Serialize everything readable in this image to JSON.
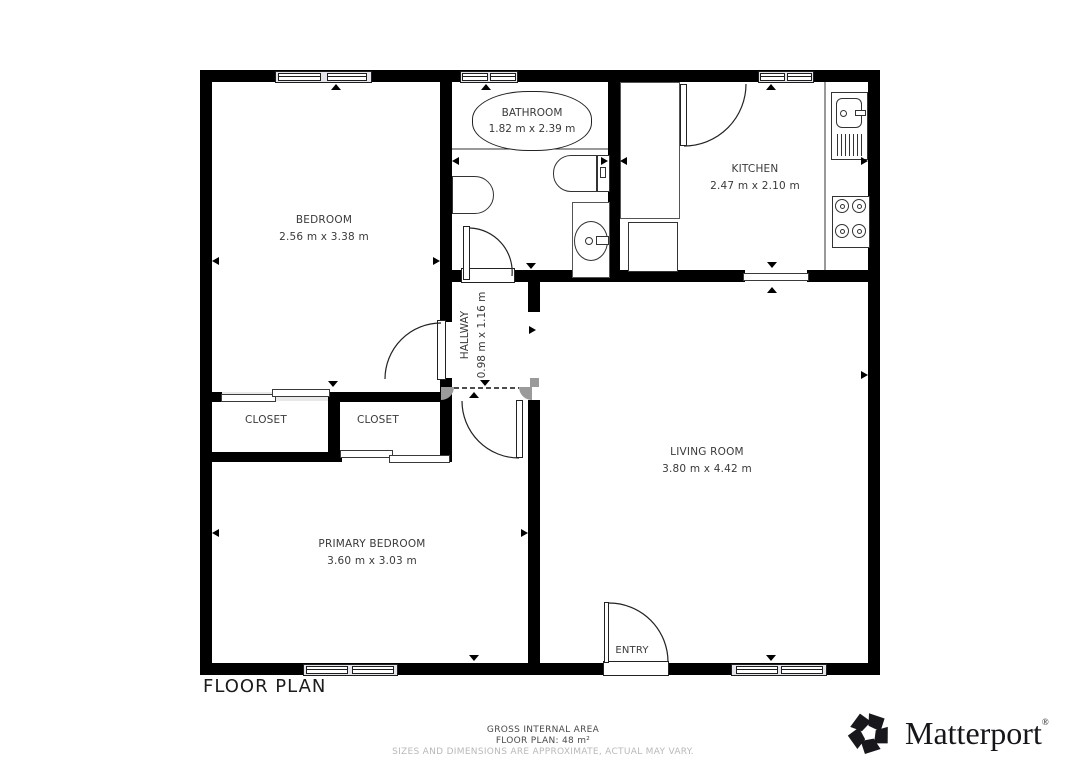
{
  "page_title": "FLOOR PLAN",
  "rooms": {
    "bedroom": {
      "name": "BEDROOM",
      "dims": "2.56 m x 3.38 m"
    },
    "bathroom": {
      "name": "BATHROOM",
      "dims": "1.82 m x 2.39 m"
    },
    "kitchen": {
      "name": "KITCHEN",
      "dims": "2.47 m x 2.10 m"
    },
    "hallway": {
      "name": "HALLWAY",
      "dims": "0.98 m x 1.16 m"
    },
    "closet_left": {
      "name": "CLOSET"
    },
    "closet_right": {
      "name": "CLOSET"
    },
    "living_room": {
      "name": "LIVING ROOM",
      "dims": "3.80 m x 4.42 m"
    },
    "primary_bedroom": {
      "name": "PRIMARY BEDROOM",
      "dims": "3.60 m x 3.03 m"
    },
    "entry": {
      "name": "ENTRY"
    }
  },
  "footer": {
    "gross_area_label": "GROSS INTERNAL AREA",
    "floor_plan_area": "FLOOR PLAN: 48 m²",
    "disclaimer": "SIZES AND DIMENSIONS ARE APPROXIMATE, ACTUAL MAY VARY."
  },
  "branding": {
    "wordmark": "Matterport",
    "registered_mark": "®"
  },
  "colors": {
    "wall": "#000000",
    "label_text": "#3a3a3a",
    "muted_text": "#b9b9b9",
    "fixture_line": "#333333",
    "opening_cap_gray": "#9a9a9a"
  }
}
